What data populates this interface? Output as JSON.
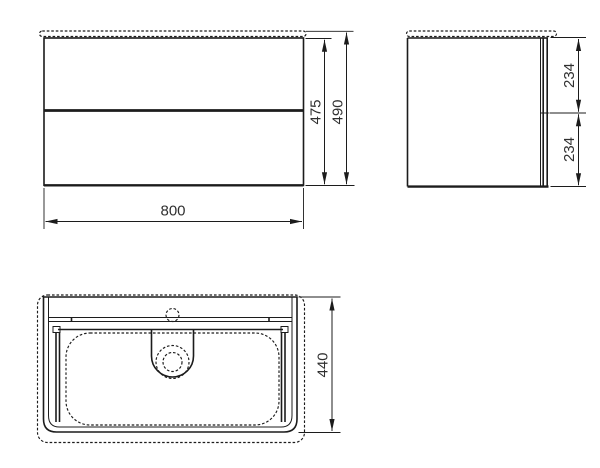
{
  "drawing": {
    "colors": {
      "line": "#1c1c1c",
      "text": "#303030",
      "background": "#ffffff"
    },
    "views": {
      "front": {
        "dim_width": {
          "label": "800",
          "value": 800
        },
        "dim_height_carcass": {
          "label": "475",
          "value": 475
        },
        "dim_height_total": {
          "label": "490",
          "value": 490
        }
      },
      "side": {
        "dim_drawer_top": {
          "label": "234",
          "value": 234
        },
        "dim_drawer_bottom": {
          "label": "234",
          "value": 234
        }
      },
      "top": {
        "dim_depth": {
          "label": "440",
          "value": 440
        }
      }
    }
  }
}
